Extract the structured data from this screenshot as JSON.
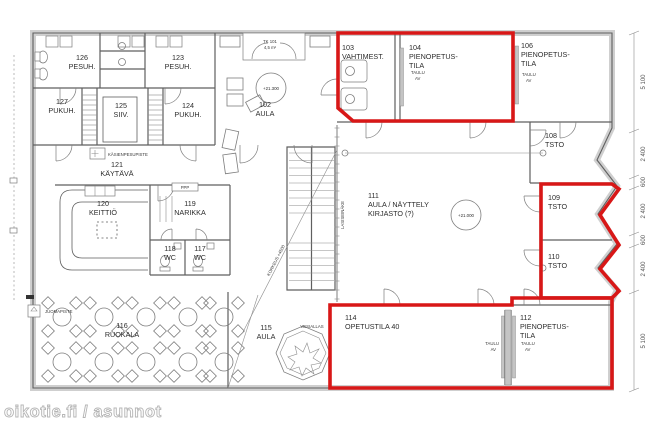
{
  "watermark": "oikotie.fi / asunnot",
  "colors": {
    "highlight": "#d81717",
    "line": "#5f5f5f"
  },
  "rooms": {
    "r126": {
      "number": "126",
      "name": "PESUH."
    },
    "r123": {
      "number": "123",
      "name": "PESUH."
    },
    "r127": {
      "number": "127",
      "name": "PUKUH."
    },
    "r125": {
      "number": "125",
      "name": "SIIV."
    },
    "r124": {
      "number": "124",
      "name": "PUKUH."
    },
    "r121": {
      "number": "121",
      "name": "KÄYTÄVÄ"
    },
    "r120": {
      "number": "120",
      "name": "KEITTIÖ"
    },
    "r119": {
      "number": "119",
      "name": "NARIKKA"
    },
    "r118": {
      "number": "118",
      "name": "WC"
    },
    "r117": {
      "number": "117",
      "name": "WC"
    },
    "r116": {
      "number": "116",
      "name": "RUOKALA"
    },
    "r102": {
      "number": "102",
      "name": "AULA"
    },
    "r103": {
      "number": "103",
      "name": "VAHTIMEST."
    },
    "r104": {
      "number": "104",
      "name": "PIENOPETUS-",
      "name2": "TILA"
    },
    "r106": {
      "number": "106",
      "name": "PIENOPETUS-",
      "name2": "TILA"
    },
    "r108": {
      "number": "108",
      "name": "TSTO"
    },
    "r111": {
      "number": "111",
      "name": "AULA / NÄYTTELY",
      "name2": "KIRJASTO (?)"
    },
    "r109": {
      "number": "109",
      "name": "TSTO"
    },
    "r110": {
      "number": "110",
      "name": "TSTO"
    },
    "r115": {
      "number": "115",
      "name": "AULA"
    },
    "r114": {
      "number": "114",
      "name": "OPETUSTILA 40"
    },
    "r112": {
      "number": "112",
      "name": "PIENOPETUS-",
      "name2": "TILA"
    }
  },
  "annotations": {
    "kasienpesupiste": "KÄSIENPESUPISTE",
    "juomapiste": "JUOMAPISTE",
    "ppp": "PPP",
    "vesiallas": "VESIALLAS",
    "lasiseinake": "LASISEINÄKE",
    "korkeus": "KORKEUS +4500",
    "tk": "TK 101",
    "tk_area": "4,5 m²",
    "taulu": "TAULU",
    "av": "AV"
  },
  "elevations": {
    "aula_102": "+21.300",
    "hall_111": "+21.000"
  },
  "dimensions": {
    "labels": [
      "5 100",
      "2 400",
      "600",
      "2 400",
      "600",
      "2 400",
      "5 100"
    ]
  }
}
